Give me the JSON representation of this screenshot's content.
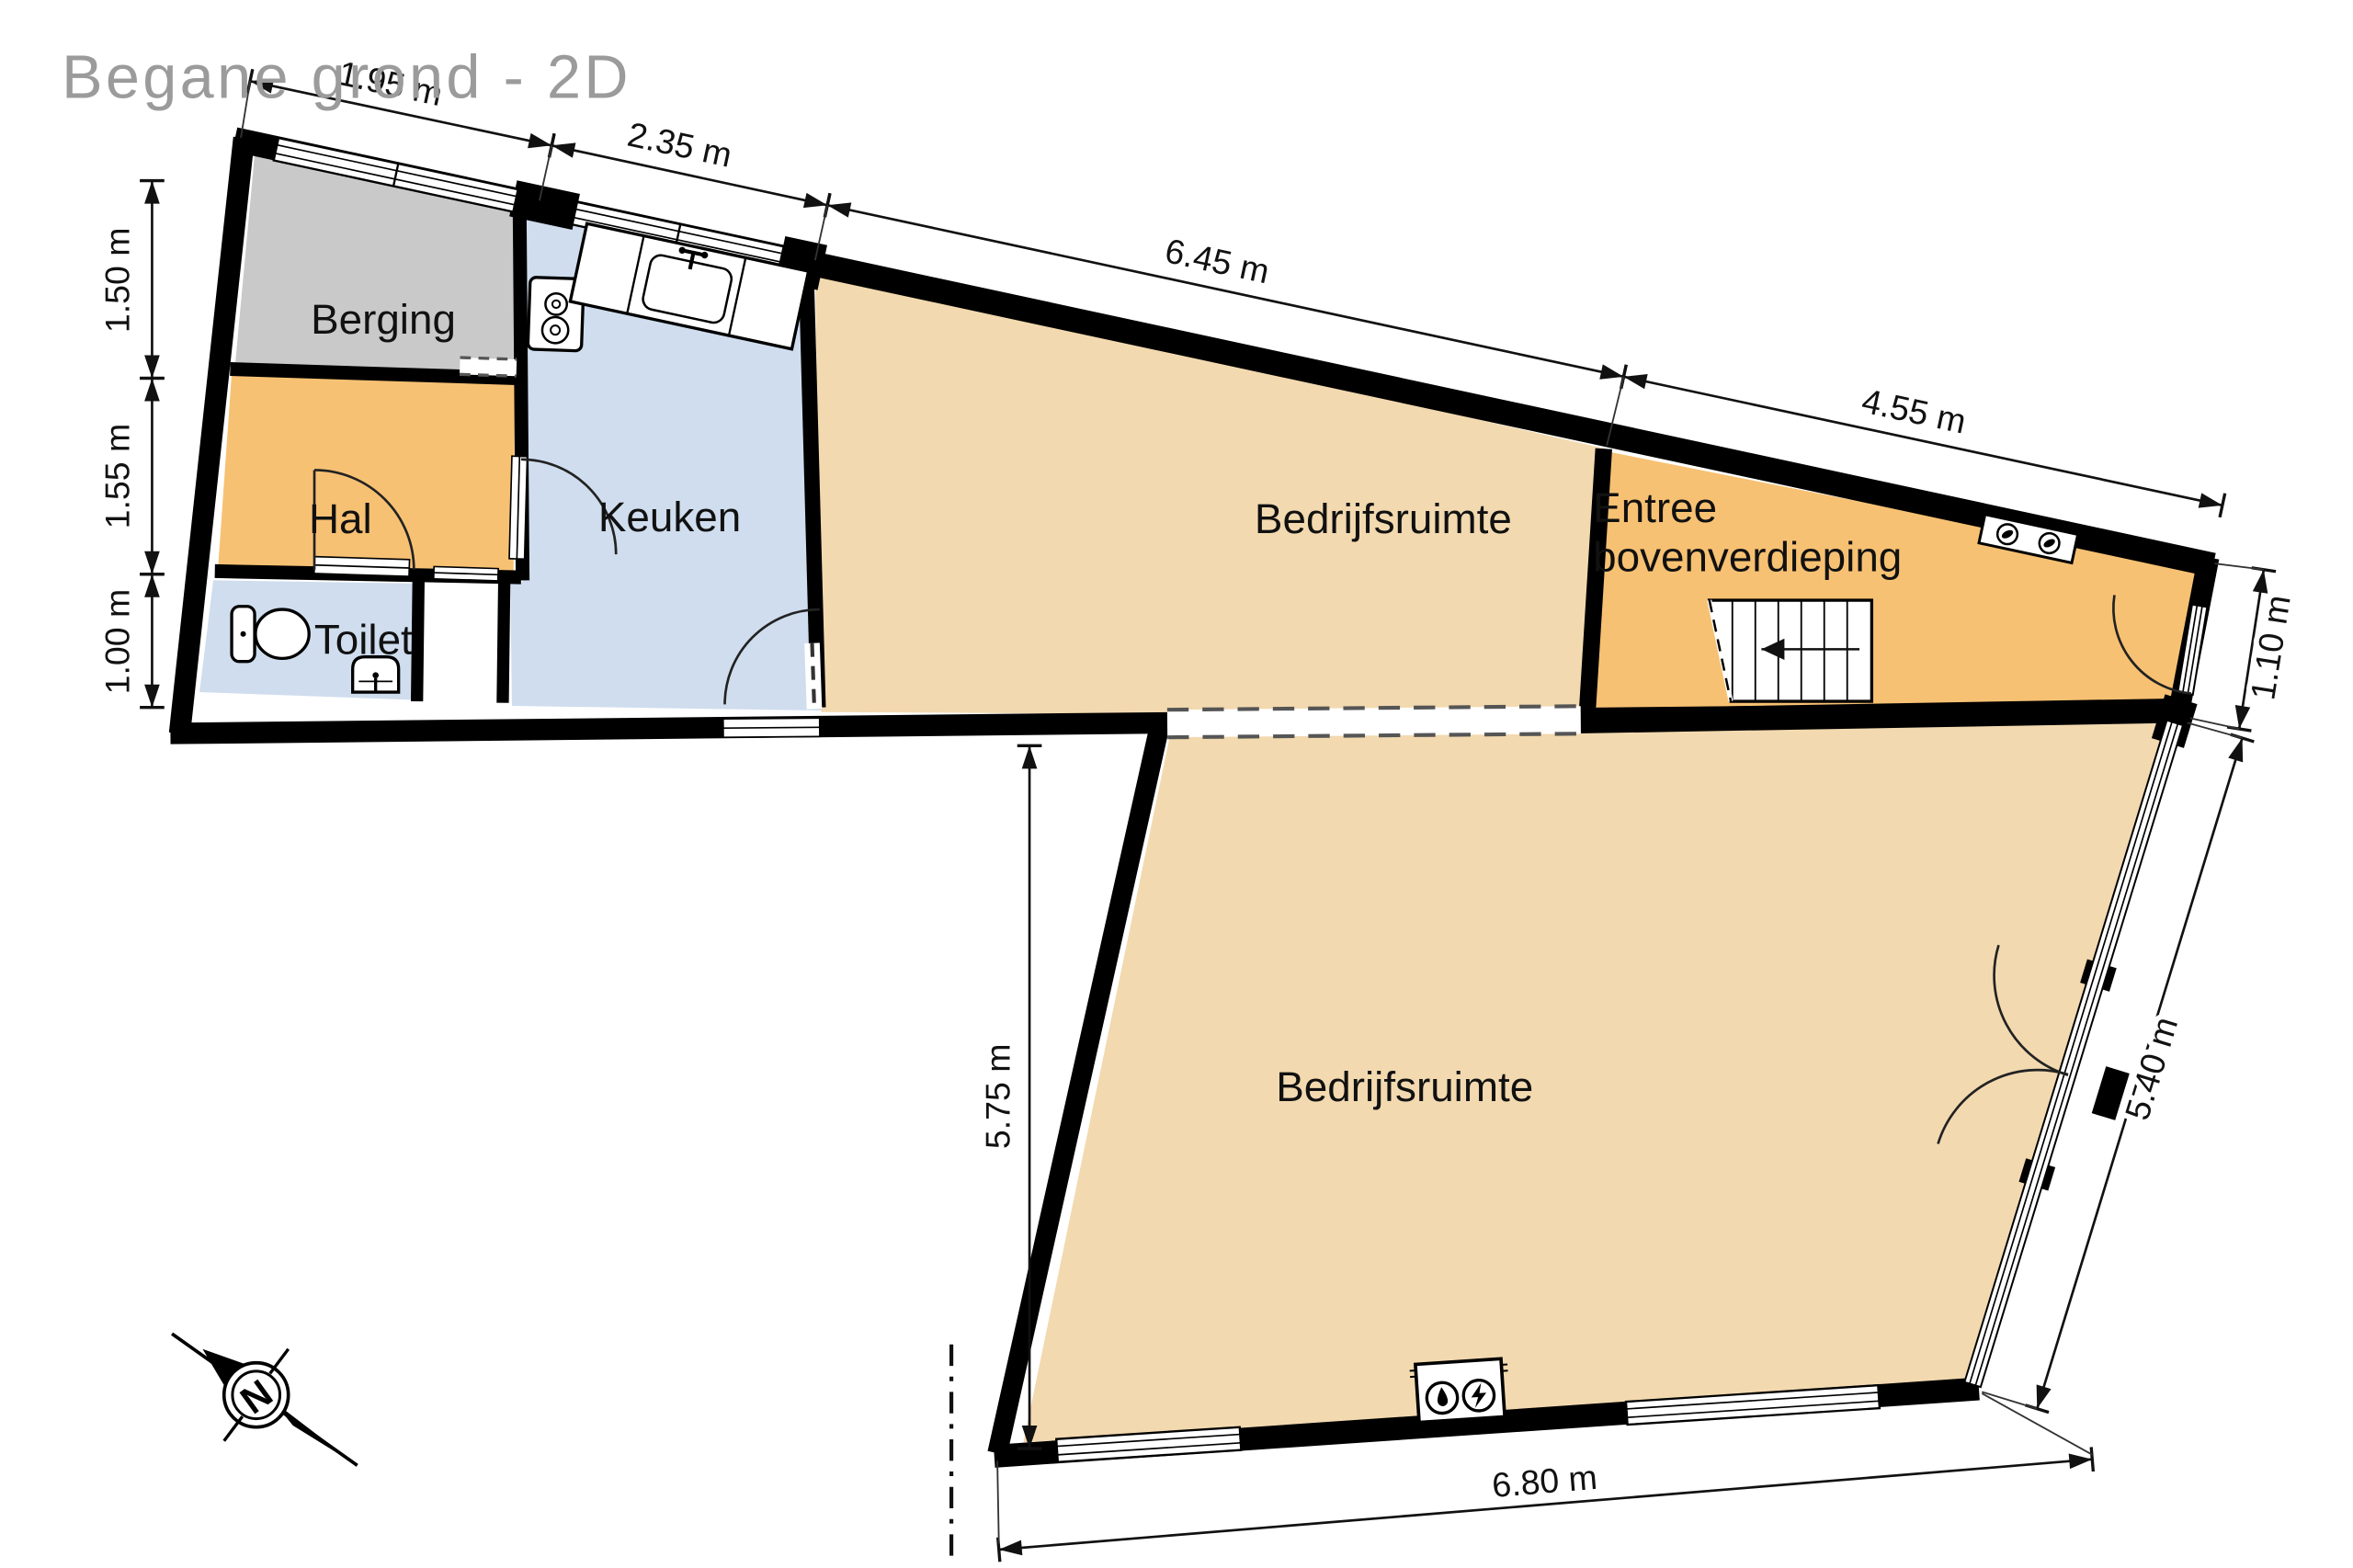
{
  "title": "Begane grond - 2D",
  "compass": {
    "north_label": "N"
  },
  "rooms": {
    "berging": "Berging",
    "hal": "Hal",
    "toilet": "Toilet",
    "keuken": "Keuken",
    "bedrijfsruimte_boven": "Bedrijfsruimte",
    "entree_line1": "Entree",
    "entree_line2": "bovenverdieping",
    "bedrijfsruimte_onder": "Bedrijfsruimte"
  },
  "dimensions": {
    "top": [
      "1.95 m",
      "2.35 m",
      "6.45 m",
      "4.55 m"
    ],
    "left": [
      "1.50 m",
      "1.55 m",
      "1.00 m"
    ],
    "door_right": "1.10 m",
    "facade_right": "5.40 m",
    "bottom": "6.80 m",
    "interior_left": "5.75 m"
  },
  "colors": {
    "wall": "#000000",
    "berging": "#c9c9c9",
    "hal": "#f7c173",
    "entree": "#f7c173",
    "toilet": "#cfddee",
    "keuken": "#cfddee",
    "bedrijfsruimte": "#f2d9af",
    "title": "#9b9b9b",
    "dash": "#555555"
  }
}
